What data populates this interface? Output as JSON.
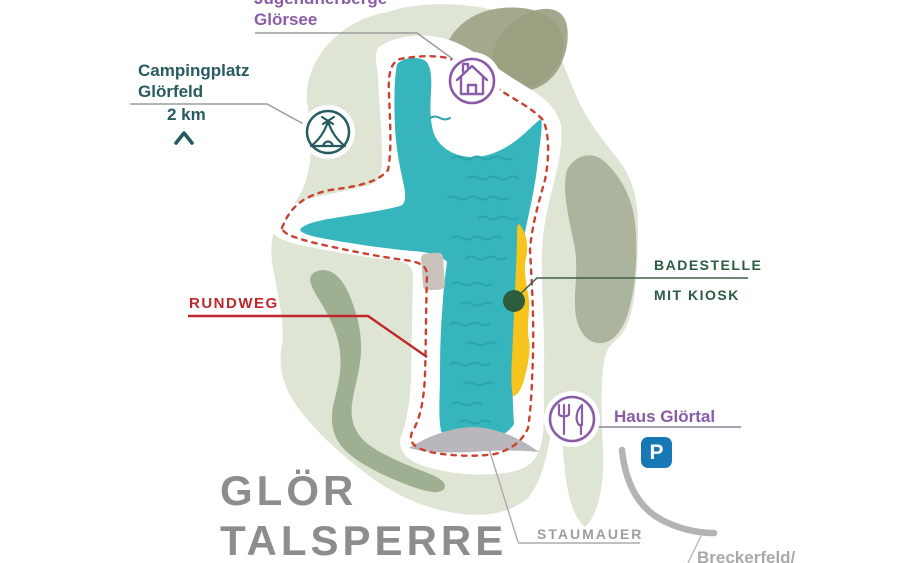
{
  "map": {
    "title": {
      "line1": "GLÖR",
      "line2": "TALSPERRE"
    },
    "labels": {
      "youth_hostel": {
        "line1": "Jugendherberge",
        "line2": "Glörsee"
      },
      "campsite": {
        "line1": "Campingplatz",
        "line2": "Glörfeld",
        "distance": "2 km"
      },
      "loop_trail": "RUNDWEG",
      "swim_spot": {
        "line1": "BADESTELLE",
        "line2": "MIT KIOSK"
      },
      "restaurant": "Haus Glörtal",
      "parking": "P",
      "dam": "STAUMAUER",
      "road_destination": "Breckerfeld/"
    },
    "icons": [
      "house-icon",
      "tent-icon",
      "fork-knife-icon",
      "parking-icon",
      "chevron-up-icon",
      "swim-spot-dot"
    ],
    "colors": {
      "lake": "#36b6bc",
      "lake_waves": "#2ba4ac",
      "island": "#dfe5d5",
      "forest_olive": "#9ca387",
      "forest_sage": "#a3b194",
      "beach_yellow": "#f6c41c",
      "trail_red_dashed": "#c8432f",
      "rundweg_red": "#c0272d",
      "purple_accent": "#8a5ca8",
      "teal_accent": "#265c60",
      "green_accent": "#2b5c40",
      "dam_gray": "#bab6bd",
      "title_gray": "#8d8d8d",
      "parking_blue": "#1878b5",
      "road_gray": "#b3b3b3"
    }
  }
}
